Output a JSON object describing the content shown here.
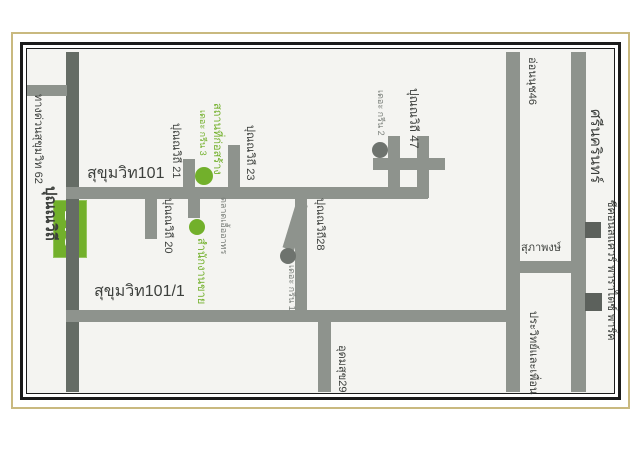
{
  "map_type": "static-location-map",
  "colors": {
    "page_bg": "#ffffff",
    "map_bg": "#f4f4f1",
    "frame_tan": "#c9b97f",
    "frame_black": "#1b1b1b",
    "road": "#8e938d",
    "road_dark": "#656c65",
    "green": "#72b02b",
    "dot_gray": "#6e736e",
    "gray_text": "#7c817c",
    "building": "#5c615c",
    "text": "#3d403d"
  },
  "bts": {
    "label": "BTS",
    "x": 53,
    "y": 200,
    "w": 34,
    "h": 58,
    "color": "green"
  },
  "roads": [
    {
      "id": "sukhumvit-main-road",
      "x": 66,
      "y": 52,
      "w": 13,
      "h": 340,
      "color": "road_dark"
    },
    {
      "id": "expressway-stub-road",
      "x": 27,
      "y": 85,
      "w": 40,
      "h": 11,
      "color": "road"
    },
    {
      "id": "sukhumvit101-road",
      "x": 66,
      "y": 187,
      "w": 362,
      "h": 12,
      "color": "road"
    },
    {
      "id": "sukhumvit101-1-road",
      "x": 66,
      "y": 310,
      "w": 454,
      "h": 12,
      "color": "road"
    },
    {
      "id": "punnawithi21-stub-road",
      "x": 183,
      "y": 159,
      "w": 12,
      "h": 30,
      "color": "road"
    },
    {
      "id": "punnawithi23-stub-road",
      "x": 228,
      "y": 145,
      "w": 12,
      "h": 44,
      "color": "road"
    },
    {
      "id": "punnawithi20-stub-road",
      "x": 145,
      "y": 198,
      "w": 12,
      "h": 41,
      "color": "road"
    },
    {
      "id": "sales-office-stub-road",
      "x": 188,
      "y": 198,
      "w": 12,
      "h": 20,
      "color": "road"
    },
    {
      "id": "punnawithi28-road",
      "x": 295,
      "y": 198,
      "w": 12,
      "h": 113,
      "color": "road"
    },
    {
      "id": "green1-spur-road",
      "x": 296,
      "y": 204,
      "w": 12,
      "h": 47,
      "color": "road",
      "rot": 17
    },
    {
      "id": "punnawithi47-west-road",
      "x": 388,
      "y": 136,
      "w": 12,
      "h": 62,
      "color": "road"
    },
    {
      "id": "punnawithi47-east-road",
      "x": 417,
      "y": 136,
      "w": 12,
      "h": 62,
      "color": "road"
    },
    {
      "id": "punnawithi47-cross-road",
      "x": 373,
      "y": 158,
      "w": 72,
      "h": 12,
      "color": "road"
    },
    {
      "id": "onnut46-road",
      "x": 506,
      "y": 52,
      "w": 14,
      "h": 340,
      "color": "road"
    },
    {
      "id": "srinakarin-road",
      "x": 571,
      "y": 52,
      "w": 15,
      "h": 340,
      "color": "road"
    },
    {
      "id": "supaphong-connector-road",
      "x": 520,
      "y": 261,
      "w": 51,
      "h": 12,
      "color": "road"
    },
    {
      "id": "udomsuk29-road",
      "x": 318,
      "y": 322,
      "w": 13,
      "h": 70,
      "color": "road"
    }
  ],
  "labels": [
    {
      "id": "expressway-label",
      "text": "ทางด่วนสุขุมวิท 62",
      "x": 43,
      "y": 94,
      "rot": 90,
      "size": 11,
      "color": "text"
    },
    {
      "id": "punnawithi-station-label",
      "text": "ปุณณวิถี",
      "x": 58,
      "y": 186,
      "rot": 90,
      "size": 15,
      "color": "text",
      "bold": true
    },
    {
      "id": "sukhumvit101-label",
      "text": "สุขุมวิท101",
      "x": 87,
      "y": 166,
      "rot": 0,
      "size": 16,
      "color": "text"
    },
    {
      "id": "sukhumvit101-1-label",
      "text": "สุขุมวิท101/1",
      "x": 94,
      "y": 284,
      "rot": 0,
      "size": 16,
      "color": "text"
    },
    {
      "id": "punnawithi21-label",
      "text": "ปุณณวิถี 21",
      "x": 181,
      "y": 123,
      "rot": 90,
      "size": 11,
      "color": "text"
    },
    {
      "id": "green3-construction-label",
      "text": "สถานที่ก่อสร้าง",
      "x": 222,
      "y": 103,
      "rot": 90,
      "size": 11,
      "color": "green"
    },
    {
      "id": "green3-name-label",
      "text": "เดอะ กรีน 3",
      "x": 207,
      "y": 110,
      "rot": 90,
      "size": 9,
      "color": "green"
    },
    {
      "id": "punnawithi23-label",
      "text": "ปุณณวิถี 23",
      "x": 255,
      "y": 125,
      "rot": 90,
      "size": 11,
      "color": "text"
    },
    {
      "id": "punnawithi20-label",
      "text": "ปุณณวิถี 20",
      "x": 173,
      "y": 198,
      "rot": 90,
      "size": 11,
      "color": "text"
    },
    {
      "id": "market-label",
      "text": "ตลาดเอื้ออาทร",
      "x": 228,
      "y": 197,
      "rot": 90,
      "size": 9,
      "color": "gray_text"
    },
    {
      "id": "sales-office-label",
      "text": "สำนักงานขาย",
      "x": 206,
      "y": 238,
      "rot": 90,
      "size": 11,
      "color": "green"
    },
    {
      "id": "punnawithi28-label",
      "text": "ปุณณวิถี28",
      "x": 325,
      "y": 198,
      "rot": 90,
      "size": 11,
      "color": "text"
    },
    {
      "id": "green1-name-label",
      "text": "เดอะ กรีน 1",
      "x": 296,
      "y": 265,
      "rot": 90,
      "size": 9,
      "color": "gray_text"
    },
    {
      "id": "punnawithi47-label",
      "text": "ปุณณวิถี 47",
      "x": 420,
      "y": 88,
      "rot": 90,
      "size": 12,
      "color": "text"
    },
    {
      "id": "green2-name-label",
      "text": "เดอะ กรีน 2",
      "x": 385,
      "y": 90,
      "rot": 90,
      "size": 9,
      "color": "gray_text"
    },
    {
      "id": "onnut46-label",
      "text": "อ่อนนุช46",
      "x": 537,
      "y": 57,
      "rot": 90,
      "size": 11,
      "color": "text"
    },
    {
      "id": "srinakarin-label",
      "text": "ศรีนครินทร์",
      "x": 603,
      "y": 109,
      "rot": 90,
      "size": 15,
      "color": "text"
    },
    {
      "id": "supaphong-label",
      "text": "สุภาพงษ์",
      "x": 521,
      "y": 243,
      "rot": 0,
      "size": 11,
      "color": "text"
    },
    {
      "id": "prawit-label",
      "text": "ประวิทย์และเพื่อน",
      "x": 538,
      "y": 311,
      "rot": 90,
      "size": 11,
      "color": "text"
    },
    {
      "id": "udomsuk29-label",
      "text": "อุดมสุข29",
      "x": 347,
      "y": 345,
      "rot": 90,
      "size": 11,
      "color": "text"
    },
    {
      "id": "seacon-paradise-label",
      "text": "ซีคอนสแควร์ พาราไดซ์ พาร์ค",
      "x": 616,
      "y": 200,
      "rot": 90,
      "size": 11,
      "color": "text"
    }
  ],
  "markers": [
    {
      "id": "green3-marker",
      "cx": 204,
      "cy": 176,
      "r": 9,
      "color": "green"
    },
    {
      "id": "sales-office-marker",
      "cx": 197,
      "cy": 227,
      "r": 8,
      "color": "green"
    },
    {
      "id": "green1-marker",
      "cx": 288,
      "cy": 256,
      "r": 8,
      "color": "dot_gray"
    },
    {
      "id": "green2-marker",
      "cx": 380,
      "cy": 150,
      "r": 8,
      "color": "dot_gray"
    }
  ],
  "buildings": [
    {
      "id": "seacon-square-building",
      "x": 585,
      "y": 222,
      "w": 16,
      "h": 16
    },
    {
      "id": "paradise-park-building",
      "x": 585,
      "y": 293,
      "w": 17,
      "h": 18
    }
  ]
}
